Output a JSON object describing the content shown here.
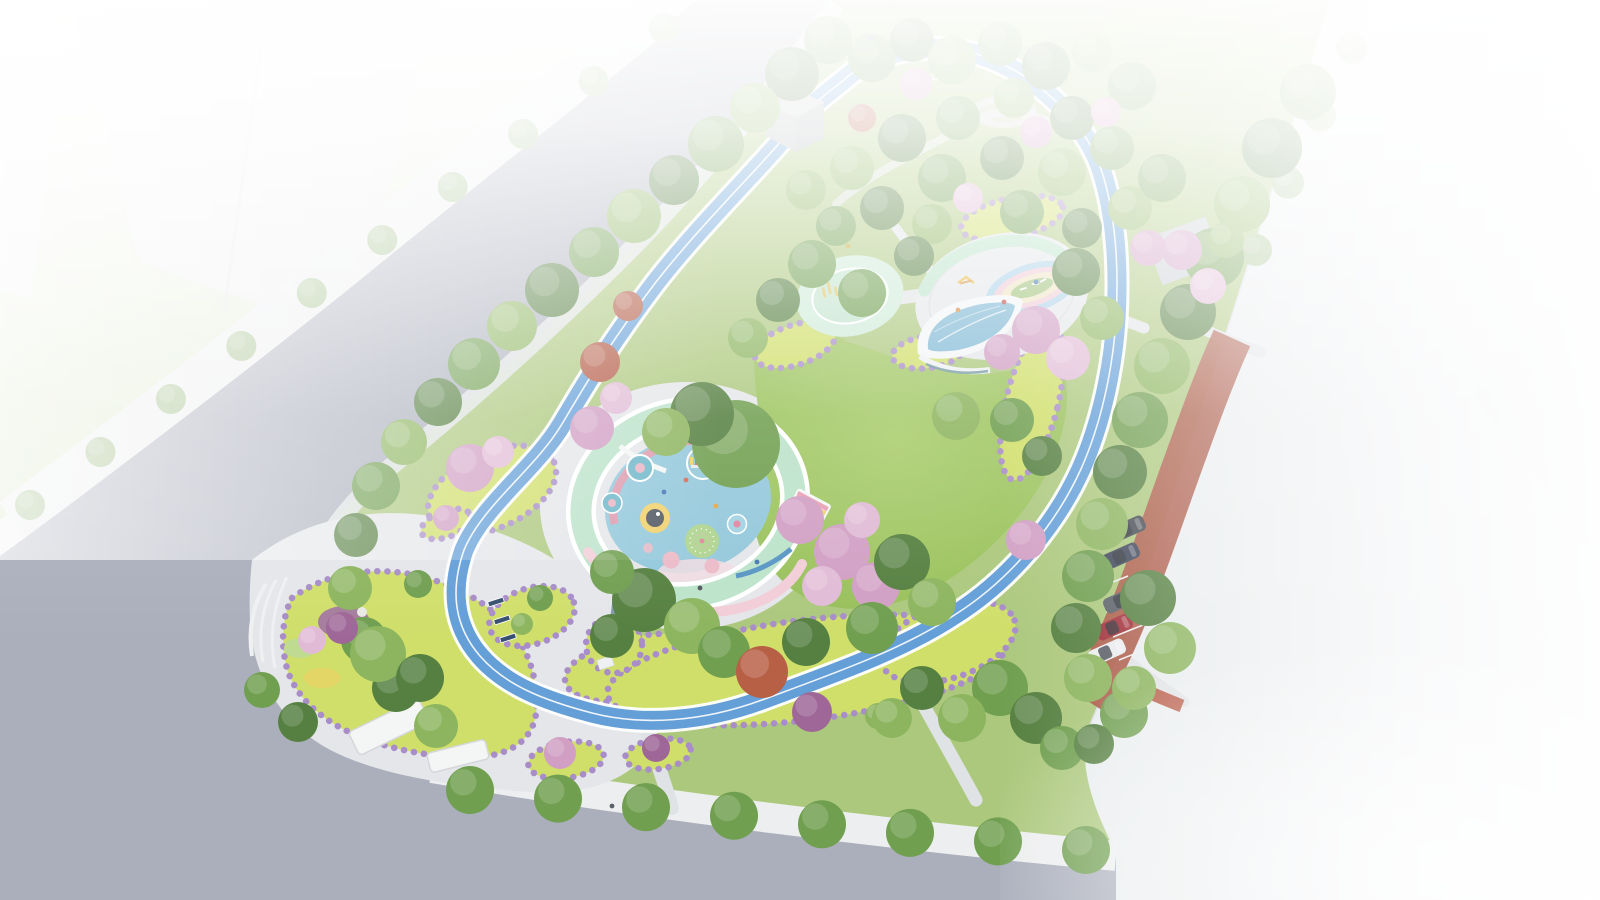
{
  "image": {
    "type": "architectural-aerial-rendering",
    "subject": "children's pocket park master plan with circular playground pavilion, looped blue running track, lawns and street trees"
  },
  "palette": {
    "base": "#f2f3f4",
    "field1": "#f2f5ef",
    "field2": "#d8e6c4",
    "road": "#a7abb9",
    "sidewalk": "#eceeef",
    "parkEdge": "#dfe2e3",
    "park": "#a8c676",
    "lawn1": "#a6cb66",
    "lawn2": "#8db64e",
    "plaza": "#e3e5e8",
    "path": "#dfe2e4",
    "track": "#5c9ad6",
    "chartreuse": "#cede62",
    "purpleBorder": "#a487c6",
    "mint": "#b9e2c8",
    "mintPad": "#cdead7",
    "floor": "#8ec6da",
    "pinkWall": "#f2cbd5",
    "pinkRing": "#dc96aa",
    "redGround": "#a8513d",
    "bldg": "#e9ecef",
    "glass": "#7ab6d3",
    "white": "#ffffff"
  },
  "scene": {
    "tree_types": {
      "g1": "#4d7a37",
      "g2": "#699a47",
      "g3": "#87b257",
      "g4": "#a6c464",
      "st": "#9dbd85",
      "pink": "#cf9ac1",
      "pink2": "#e0b8d4",
      "red": "#ae5038",
      "rust": "#b4583c",
      "purple": "#995f92"
    },
    "trees": [
      [
        828,
        40,
        24,
        "g2"
      ],
      [
        792,
        74,
        27,
        "g1"
      ],
      [
        755,
        108,
        25,
        "g3"
      ],
      [
        716,
        144,
        28,
        "g2"
      ],
      [
        674,
        180,
        25,
        "g1"
      ],
      [
        634,
        216,
        27,
        "g3"
      ],
      [
        594,
        252,
        25,
        "g2"
      ],
      [
        552,
        290,
        27,
        "g1"
      ],
      [
        512,
        326,
        25,
        "g3"
      ],
      [
        474,
        364,
        26,
        "g2"
      ],
      [
        438,
        402,
        24,
        "g1"
      ],
      [
        404,
        442,
        23,
        "g3"
      ],
      [
        376,
        486,
        24,
        "g2"
      ],
      [
        356,
        535,
        22,
        "g1"
      ],
      [
        350,
        588,
        22,
        "g3"
      ],
      [
        364,
        640,
        23,
        "g2"
      ],
      [
        396,
        688,
        24,
        "g1"
      ],
      [
        436,
        726,
        22,
        "g3"
      ],
      [
        1308,
        92,
        28,
        "g2"
      ],
      [
        1272,
        148,
        30,
        "g1"
      ],
      [
        1242,
        204,
        28,
        "g3"
      ],
      [
        1214,
        258,
        30,
        "g2"
      ],
      [
        1188,
        312,
        28,
        "g1"
      ],
      [
        1162,
        366,
        28,
        "g3"
      ],
      [
        1140,
        420,
        28,
        "g2"
      ],
      [
        1120,
        472,
        27,
        "g1"
      ],
      [
        1102,
        524,
        26,
        "g3"
      ],
      [
        1088,
        576,
        26,
        "g2"
      ],
      [
        1076,
        628,
        25,
        "g1"
      ],
      [
        1088,
        678,
        24,
        "g3"
      ],
      [
        1124,
        714,
        24,
        "g2"
      ],
      [
        1148,
        598,
        28,
        "g1"
      ],
      [
        1170,
        648,
        26,
        "g3"
      ],
      [
        872,
        58,
        24,
        "g2"
      ],
      [
        912,
        40,
        22,
        "g1"
      ],
      [
        952,
        60,
        24,
        "g3"
      ],
      [
        1000,
        44,
        22,
        "g2"
      ],
      [
        1046,
        66,
        24,
        "g1"
      ],
      [
        1092,
        52,
        20,
        "g3"
      ],
      [
        1132,
        86,
        24,
        "g2"
      ],
      [
        1072,
        118,
        22,
        "g1"
      ],
      [
        1014,
        98,
        20,
        "g3"
      ],
      [
        958,
        118,
        22,
        "g2"
      ],
      [
        902,
        138,
        24,
        "g1"
      ],
      [
        852,
        168,
        22,
        "g3"
      ],
      [
        942,
        178,
        24,
        "g2"
      ],
      [
        1002,
        158,
        22,
        "g1"
      ],
      [
        1062,
        172,
        24,
        "g3"
      ],
      [
        1112,
        148,
        22,
        "g2"
      ],
      [
        882,
        208,
        22,
        "g1"
      ],
      [
        932,
        224,
        20,
        "g3"
      ],
      [
        1022,
        212,
        22,
        "g2"
      ],
      [
        1082,
        228,
        20,
        "g1"
      ],
      [
        1130,
        208,
        22,
        "g3"
      ],
      [
        1162,
        178,
        24,
        "g2"
      ],
      [
        916,
        84,
        16,
        "pink"
      ],
      [
        1036,
        132,
        16,
        "pink"
      ],
      [
        968,
        198,
        15,
        "pink2"
      ],
      [
        1106,
        112,
        15,
        "pink"
      ],
      [
        862,
        118,
        14,
        "red"
      ],
      [
        1148,
        248,
        18,
        "pink"
      ],
      [
        836,
        226,
        20,
        "g2"
      ],
      [
        806,
        190,
        20,
        "g3"
      ],
      [
        736,
        444,
        44,
        "g2"
      ],
      [
        702,
        414,
        32,
        "g1"
      ],
      [
        666,
        432,
        24,
        "g3"
      ],
      [
        592,
        428,
        22,
        "pink"
      ],
      [
        616,
        398,
        16,
        "pink2"
      ],
      [
        600,
        362,
        20,
        "red"
      ],
      [
        628,
        306,
        15,
        "red"
      ],
      [
        644,
        600,
        32,
        "g1"
      ],
      [
        692,
        626,
        28,
        "g3"
      ],
      [
        612,
        572,
        22,
        "g2"
      ],
      [
        724,
        652,
        26,
        "g2"
      ],
      [
        800,
        520,
        24,
        "pink"
      ],
      [
        842,
        552,
        28,
        "pink"
      ],
      [
        876,
        586,
        24,
        "pink"
      ],
      [
        822,
        586,
        20,
        "pink2"
      ],
      [
        862,
        520,
        18,
        "pink2"
      ],
      [
        902,
        562,
        28,
        "g1"
      ],
      [
        932,
        602,
        24,
        "g3"
      ],
      [
        872,
        628,
        26,
        "g2"
      ],
      [
        806,
        642,
        24,
        "g1"
      ],
      [
        812,
        264,
        24,
        "g2"
      ],
      [
        778,
        300,
        22,
        "g1"
      ],
      [
        748,
        338,
        20,
        "g3"
      ],
      [
        862,
        293,
        24,
        "g2"
      ],
      [
        914,
        256,
        20,
        "g1"
      ],
      [
        1076,
        272,
        24,
        "g1"
      ],
      [
        1102,
        318,
        22,
        "g3"
      ],
      [
        1036,
        330,
        24,
        "pink"
      ],
      [
        1068,
        358,
        22,
        "pink2"
      ],
      [
        1002,
        352,
        18,
        "pink"
      ],
      [
        1012,
        420,
        22,
        "g2"
      ],
      [
        1042,
        456,
        20,
        "g1"
      ],
      [
        956,
        416,
        24,
        "g3"
      ],
      [
        1026,
        540,
        20,
        "pink"
      ],
      [
        762,
        672,
        26,
        "rust"
      ],
      [
        812,
        712,
        20,
        "purple"
      ],
      [
        878,
        716,
        13,
        "g3"
      ],
      [
        470,
        468,
        24,
        "pink"
      ],
      [
        498,
        452,
        16,
        "pink2"
      ],
      [
        540,
        598,
        13,
        "g2"
      ],
      [
        522,
        624,
        11,
        "g3"
      ],
      [
        612,
        636,
        22,
        "g1"
      ],
      [
        560,
        753,
        16,
        "pink"
      ],
      [
        656,
        748,
        14,
        "purple"
      ],
      [
        378,
        654,
        28,
        "g3"
      ],
      [
        420,
        678,
        24,
        "g1"
      ],
      [
        342,
        628,
        16,
        "purple"
      ],
      [
        312,
        640,
        14,
        "pink2"
      ],
      [
        446,
        518,
        13,
        "pink"
      ],
      [
        418,
        584,
        14,
        "g2"
      ],
      [
        1000,
        688,
        28,
        "g2"
      ],
      [
        1036,
        718,
        26,
        "g1"
      ],
      [
        962,
        718,
        24,
        "g3"
      ],
      [
        1062,
        748,
        22,
        "g2"
      ],
      [
        922,
        688,
        22,
        "g1"
      ],
      [
        892,
        718,
        20,
        "g3"
      ],
      [
        1094,
        744,
        20,
        "g1"
      ],
      [
        1134,
        688,
        22,
        "g3"
      ],
      [
        1182,
        250,
        20,
        "pink"
      ],
      [
        1208,
        286,
        18,
        "pink2"
      ],
      [
        1226,
        240,
        18,
        "g3"
      ],
      [
        298,
        722,
        20,
        "g1"
      ],
      [
        262,
        690,
        18,
        "g2"
      ]
    ],
    "street_tree_rows": [
      {
        "x1": 664,
        "y1": 28,
        "x2": 30,
        "y2": 505,
        "n": 10,
        "r": 15,
        "type": "st",
        "pad": true
      },
      {
        "x1": 470,
        "y1": 790,
        "x2": 1086,
        "y2": 850,
        "n": 8,
        "r": 24,
        "type": "g2",
        "pad": false
      },
      {
        "x1": 1352,
        "y1": 48,
        "x2": 1256,
        "y2": 250,
        "n": 4,
        "r": 16,
        "type": "st",
        "pad": false
      }
    ],
    "cars": [
      {
        "x": 1122,
        "y": 600,
        "color": "#53585f"
      },
      {
        "x": 1114,
        "y": 627,
        "color": "#9c2631"
      },
      {
        "x": 1107,
        "y": 652,
        "color": "#e9ebed"
      },
      {
        "x": 1121,
        "y": 556,
        "color": "#333c50"
      },
      {
        "x": 1127,
        "y": 529,
        "color": "#3b4047"
      }
    ],
    "people": [
      {
        "x": 757,
        "y": 562,
        "c": "#3a6fb0"
      },
      {
        "x": 700,
        "y": 588,
        "c": "#4a4f55"
      },
      {
        "x": 1004,
        "y": 302,
        "c": "#c04343"
      },
      {
        "x": 1036,
        "y": 282,
        "c": "#3a6fb0"
      },
      {
        "x": 958,
        "y": 310,
        "c": "#d88a3a"
      },
      {
        "x": 848,
        "y": 246,
        "c": "#c9a227"
      },
      {
        "x": 612,
        "y": 806,
        "c": "#555a60"
      },
      {
        "x": 871,
        "y": 38,
        "c": "#4878b8"
      },
      {
        "x": 686,
        "y": 480,
        "c": "#d85f4a"
      },
      {
        "x": 664,
        "y": 492,
        "c": "#3a6fb0"
      },
      {
        "x": 716,
        "y": 506,
        "c": "#e8a23c"
      }
    ],
    "benches": [
      {
        "x": 496,
        "y": 602
      },
      {
        "x": 502,
        "y": 620
      },
      {
        "x": 508,
        "y": 638
      }
    ]
  }
}
